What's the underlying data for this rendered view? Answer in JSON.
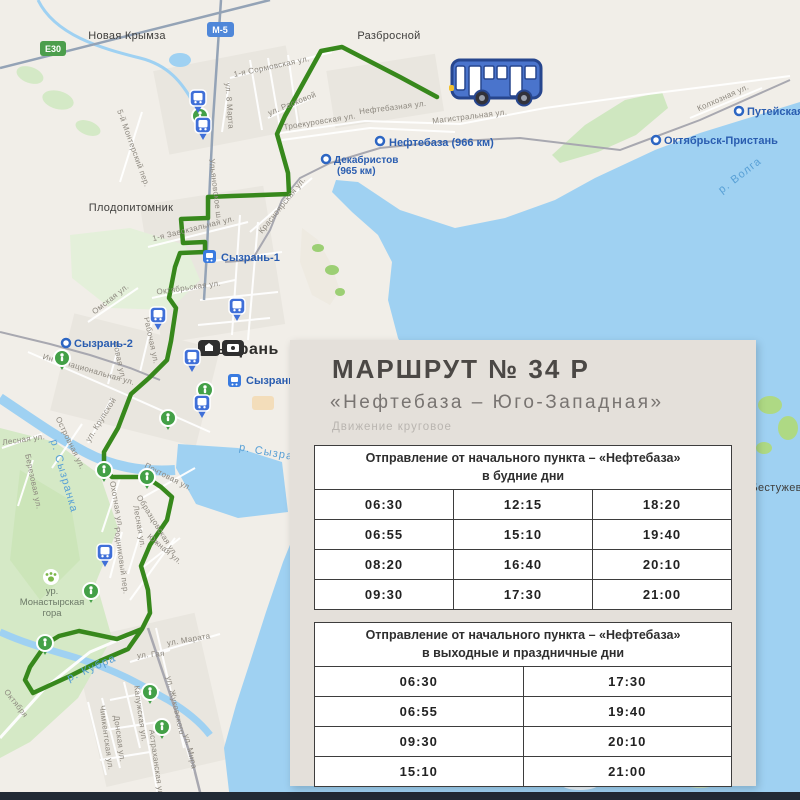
{
  "colors": {
    "map_bg": "#f1eee8",
    "water": "#9fd1f2",
    "route_green": "#37881c",
    "pin_green": "#43a047",
    "pin_blue": "#3f6fd8",
    "card_bg": "#e4e0da",
    "badge_e30_green": "#4c9e4c",
    "badge_m5_blue": "#4f87d9",
    "bus_blue": "#4a74cc"
  },
  "map": {
    "badges": [
      {
        "label": "E30"
      },
      {
        "label": "М-5"
      }
    ],
    "city_labels": {
      "novaya_krymza": "Новая Крымза",
      "razbrosnoy": "Разбросной",
      "plodopitomnik": "Плодопитомник",
      "syzran": "Сызрань",
      "bestuzhevka": "Бестужевка",
      "monastyrskaya": {
        "line1": "ур.",
        "line2": "Монастырская",
        "line3": "гора"
      }
    },
    "stations": {
      "neftebaza": "Нефтебаза (966 км)",
      "dekabristov_line1": "Декабристов",
      "dekabristov_line2": "(965 км)",
      "puteyskaya": "Путейская",
      "oktyabrsk_pristan": "Октябрьск-Пристань",
      "syzran1": "Сызрань-1",
      "syzran2": "Сызрань-2",
      "syzran_gorod": "Сызрань-город"
    },
    "rivers": {
      "volga": "р. Волга",
      "syzranka": "р. Сызранка",
      "kubra": "р. Кубра",
      "syzranka2": "р. Сызранка"
    },
    "streets": [
      "1-я Сормовская ул.",
      "ул. Расковой",
      "Троекуровская ул.",
      "Нефтебазная ул.",
      "Магистральная ул.",
      "Колхозная ул.",
      "Ульяновское ш.",
      "Красноярская ул.",
      "1-я Завокзальная ул.",
      "Октябрьская ул.",
      "5-й Монтерский пер.",
      "Омская ул.",
      "Интернациональная ул.",
      "Новая ул.",
      "Рабочая ул.",
      "ул. Крупской",
      "Островная ул.",
      "Лесная ул.",
      "Березовая ул.",
      "Почтовая ул.",
      "Охотная ул.",
      "Родниковый пер.",
      "Лесная ул.",
      "Образцовская ул.",
      "Южная ул.",
      "ул. Марата",
      "ул. Гая",
      "ул. Жуковского",
      "ул. Мира",
      "Калужская ул.",
      "Астраханская ул.",
      "Донская ул.",
      "Чимкентская ул.",
      "Октября",
      "ул. 8 Марта"
    ]
  },
  "card": {
    "title": "МАРШРУТ № 34 Р",
    "subtitle": "«Нефтебаза – Юго-Западная»",
    "note": "Движение круговое",
    "footer": "Город Сызрань",
    "weekday_table": {
      "header_line1": "Отправление от начального пункта – «Нефтебаза»",
      "header_line2": "в будние дни",
      "rows": [
        [
          "06:30",
          "12:15",
          "18:20"
        ],
        [
          "06:55",
          "15:10",
          "19:40"
        ],
        [
          "08:20",
          "16:40",
          "20:10"
        ],
        [
          "09:30",
          "17:30",
          "21:00"
        ]
      ]
    },
    "weekend_table": {
      "header_line1": "Отправление от начального пункта – «Нефтебаза»",
      "header_line2": "в выходные и праздничные дни",
      "rows": [
        [
          "06:30",
          "17:30"
        ],
        [
          "06:55",
          "19:40"
        ],
        [
          "09:30",
          "20:10"
        ],
        [
          "15:10",
          "21:00"
        ]
      ]
    }
  }
}
